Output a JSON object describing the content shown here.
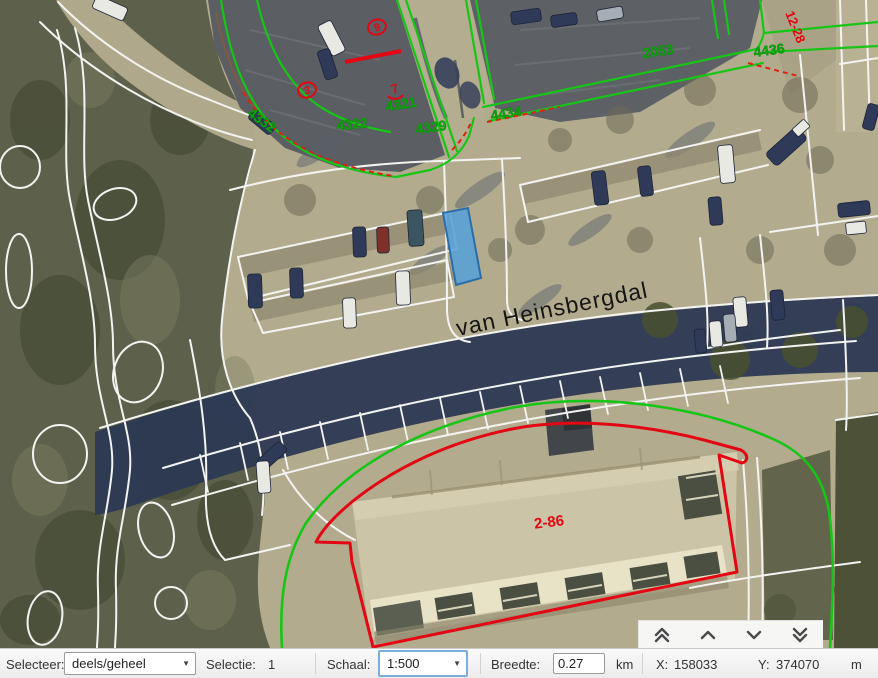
{
  "map": {
    "street_name": "van Heinsbergdal",
    "parcel_labels": [
      "4332",
      "4322",
      "4321",
      "4329",
      "4434",
      "2053",
      "4436"
    ],
    "red_marks": {
      "m9": "9",
      "m3": "3",
      "m7": "7",
      "m1228": "12-28",
      "m286": "2-86"
    },
    "colors": {
      "cadastral_green": "#17c517",
      "highlight_red": "#e30613",
      "selection_fill": "#57a0d8",
      "selection_border": "#2b6da8"
    }
  },
  "nav": {
    "buttons": [
      {
        "icon": "double-chevron-up"
      },
      {
        "icon": "chevron-up"
      },
      {
        "icon": "chevron-down"
      },
      {
        "icon": "double-chevron-down"
      }
    ]
  },
  "toolbar": {
    "selecteer_label": "Selecteer:",
    "selecteer_value": "deels/geheel",
    "selectie_label": "Selectie:",
    "selectie_value": "1",
    "schaal_label": "Schaal:",
    "schaal_value": "1:500",
    "breedte_label": "Breedte:",
    "breedte_value": "0.27",
    "breedte_unit": "km",
    "x_label": "X:",
    "x_value": "158033",
    "y_label": "Y:",
    "y_value": "374070",
    "coord_unit": "m"
  }
}
